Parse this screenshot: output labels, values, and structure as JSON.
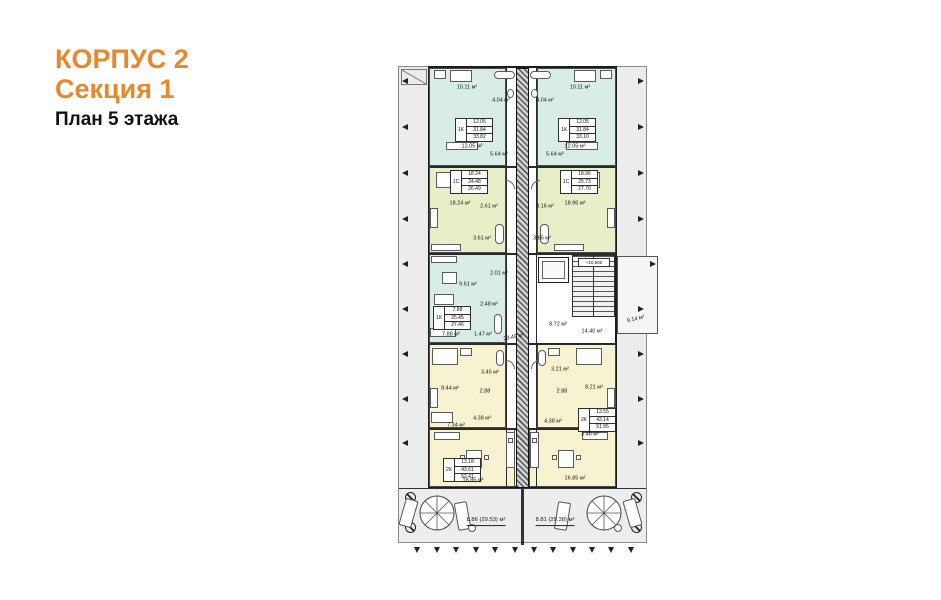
{
  "title": {
    "building": "КОРПУС 2",
    "section": "Секция 1",
    "floor": "План 5 этажа"
  },
  "plan": {
    "core": {
      "corridor": "29.49 м²",
      "lobby": "8.72 м²",
      "hall": "14.40 м²",
      "balcony": "9.14 м²",
      "elevation": "+10.500"
    },
    "terrace": {
      "left": "8.86 (29.53) м²",
      "right": "8.81 (29.38) м²"
    },
    "apartments": [
      {
        "type": "1К",
        "a1": "12.05",
        "a2": "31.84",
        "a3": "33.82",
        "loggia": "10.11 м²",
        "bath": "4.04 м²",
        "room": "12.05 м²",
        "kitchen": "5.64 м²"
      },
      {
        "type": "1К",
        "a1": "12.05",
        "a2": "31.84",
        "a3": "33.10",
        "loggia": "10.11 м²",
        "bath": "4.04 м²",
        "room": "12.05 м²",
        "kitchen": "5.64 м²"
      },
      {
        "type": "1С",
        "a1": "18.24",
        "a2": "24.48",
        "a3": "26.49",
        "room": "18.24 м²",
        "hall": "2.61 м²",
        "bath": "3.61 м²"
      },
      {
        "type": "1С",
        "a1": "18.96",
        "a2": "25.73",
        "a3": "27.70",
        "room": "18.96 м²",
        "hall": "3.16 м²",
        "bath": "3.65 м²"
      },
      {
        "type": "1К",
        "a1": "7.88",
        "a2": "25.45",
        "a3": "27.46",
        "kitchen": "9.61 м²",
        "room": "7.88 м²",
        "hall": "2.48 м²",
        "wc": "1.47 м²",
        "storage": "2.01 м²"
      },
      {
        "type": "2К",
        "a1": "13.18",
        "a2": "43.61",
        "a3": "52.41",
        "bedroom": "8.44 м²",
        "bath": "3.45 м²",
        "hall": "2.88",
        "room2": "7.34 м²",
        "corridor": "4.38 м²",
        "living": "16.85 м²"
      },
      {
        "type": "2К",
        "a1": "13.55",
        "a2": "43.14",
        "a3": "51.95",
        "bedroom": "8.21 м²",
        "bath": "3.21 м²",
        "hall": "2.88",
        "corridor": "4.38 м²",
        "wc": "3.46 м²",
        "living": "16.85 м²"
      }
    ],
    "colors": {
      "accent": "#e8872c",
      "room_blue": "#d9ede7",
      "room_green": "#e6efc8",
      "room_yellow": "#f7f3d0"
    },
    "icons": {
      "spiral_stair": "spiral staircase",
      "dimension_arrow": "dimension tick",
      "column": "column mark"
    }
  }
}
